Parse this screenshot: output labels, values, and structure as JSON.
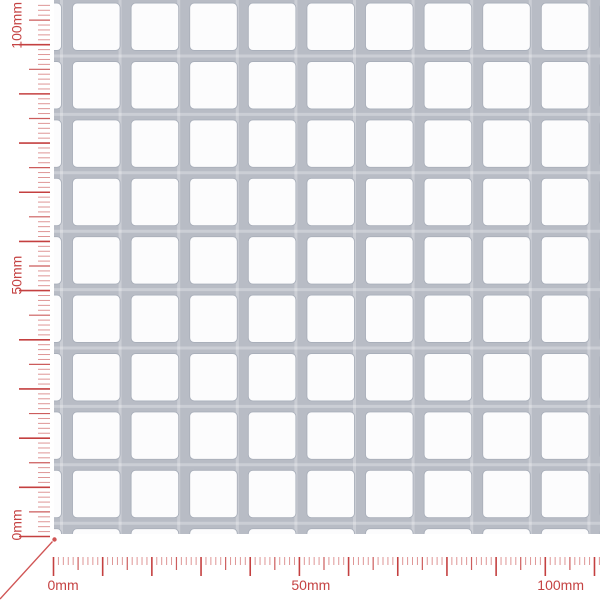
{
  "meta": {
    "description": "Preview image of a perforated metal sheet (square hole pattern) with millimetre rulers",
    "unit": "mm"
  },
  "canvas": {
    "width": 600,
    "height": 600,
    "background": "#ffffff"
  },
  "sheet": {
    "pattern": "square-holes-straight-rows",
    "metal_color": "#b8bcc5",
    "metal_highlight": "rgba(255,255,255,0.28)",
    "hole_color": "#fcfcfd",
    "hole_edge_color": "#a9afba",
    "left_px": 54,
    "top_px": 0,
    "width_px": 546,
    "height_px": 534,
    "col_hole_start_px": 72.5,
    "col_pitch_px": 58.6,
    "row_hole_start_px": 61.5,
    "row_pitch_px": 58.4,
    "hole_w_px": 47.6,
    "hole_h_px": 47.4,
    "bar_px": 11,
    "corner_radius_px": 4.5,
    "cols_from": -1,
    "cols_to": 9,
    "rows_from": -1,
    "rows_to": 8,
    "approx_hole_mm": 10,
    "approx_pitch_mm": 12
  },
  "rulers": {
    "px_per_mm": 4.918,
    "tick_color": "#c44040",
    "minor_tick_opacity": 0.55,
    "mid_tick_opacity": 0.85,
    "label_color": "#c54343",
    "label_font_px": 14,
    "bottom": {
      "baseline_y_px": 557,
      "origin_x_px": 53.5,
      "mm_max": 111,
      "tick_len": {
        "minor": 8,
        "mid": 13,
        "major": 19
      },
      "labels": [
        {
          "mm": 0,
          "text": "0mm"
        },
        {
          "mm": 50,
          "text": "50mm"
        },
        {
          "mm": 100,
          "text": "100mm"
        }
      ]
    },
    "left": {
      "baseline_x_px": 50,
      "origin_y_px": 536.5,
      "mm_max": 109,
      "tick_len": {
        "minor": 12,
        "mid": 21,
        "major": 31
      },
      "labels": [
        {
          "mm": 0,
          "text": "0mm"
        },
        {
          "mm": 50,
          "text": "50mm"
        },
        {
          "mm": 100,
          "text": "100mm"
        }
      ]
    }
  },
  "origin_pointer": {
    "x1": 0,
    "y1": 599,
    "x2": 52.5,
    "y2": 541.5,
    "dot_x": 54.5,
    "dot_y": 539.5,
    "dot_r": 2.2,
    "color": "#d05555",
    "width": 1.3
  }
}
